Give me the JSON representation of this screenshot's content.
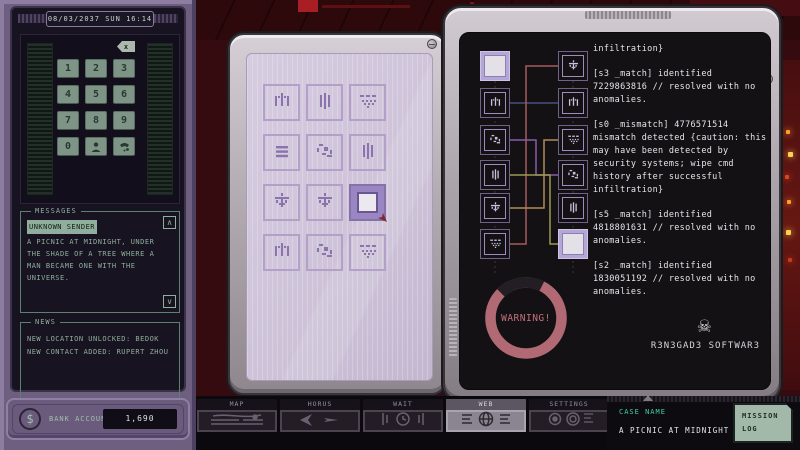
{
  "phone": {
    "status": {
      "date": "08/03/2037",
      "day": "SUN",
      "time": "16:14"
    },
    "keypad": {
      "digits": [
        "1",
        "2",
        "3",
        "4",
        "5",
        "6",
        "7",
        "8",
        "9",
        "0"
      ],
      "special": [
        {
          "name": "contact-key",
          "icon": "person-icon"
        },
        {
          "name": "call-key",
          "icon": "phone-icon"
        }
      ],
      "backspace_label": "x"
    },
    "messages": {
      "title": "MESSAGES",
      "sender": "UNKNOWN SENDER",
      "body": "A PICNIC AT MIDNIGHT, UNDER THE SHADE OF A TREE WHERE A MAN BECAME ONE WITH THE UNIVERSE.",
      "scroll_up": "∧",
      "scroll_down": "∨"
    },
    "news": {
      "title": "NEWS",
      "lines": [
        "NEW LOCATION UNLOCKED: BEDOK",
        "NEW CONTACT ADDED: RUPERT ZHOU"
      ]
    },
    "bank": {
      "label": "BANK ACCOUNT",
      "value": "1,690",
      "currency_symbol": "$"
    }
  },
  "puzzle": {
    "tiles": [
      "pillars",
      "bars",
      "dots",
      "equals",
      "scatter",
      "bars",
      "trident",
      "trident",
      "selected",
      "pillars",
      "scatter",
      "dots"
    ]
  },
  "terminal": {
    "left_nodes": [
      "selected",
      "pillars",
      "scatter",
      "bars",
      "trident",
      "dots"
    ],
    "right_nodes": [
      "trident",
      "pillars",
      "dots",
      "scatter",
      "bars",
      "selected"
    ],
    "log": [
      "infiltration}",
      "[s3 _match] identified 7229863816 // resolved with no anomalies.",
      "[s0 _mismatch] 4776571514 mismatch detected {caution: this may have been detected by security systems; wipe cmd history after successful infiltration}",
      "[s5 _match] identified 4818801631 // resolved with no anomalies.",
      "[s2 _match] identified 1830051192 // resolved with no anomalies."
    ],
    "warning": "WARNING!",
    "brand": "R3N3GAD3 SOFTWAR3",
    "brand_symbol": "☠"
  },
  "taskbar": {
    "buttons": [
      {
        "label": "MAP",
        "icon": "map-icon",
        "active": false
      },
      {
        "label": "HORUS",
        "icon": "plane-icon",
        "active": false
      },
      {
        "label": "WAIT",
        "icon": "clock-icon",
        "active": false
      },
      {
        "label": "WEB",
        "icon": "globe-icon",
        "active": true
      },
      {
        "label": "SETTINGS",
        "icon": "dials-icon",
        "active": false
      }
    ],
    "case_label": "CASE NAME",
    "case_name": "A PICNIC AT MIDNIGHT",
    "mission_log": "MISSION LOG"
  },
  "colors": {
    "accent_teal": "#3ed2a2",
    "warning_ring": "#b16a73",
    "screen_lavender": "#cfc5da",
    "sage_text": "#8fae9c",
    "node_purple": "#9c8cbc"
  }
}
